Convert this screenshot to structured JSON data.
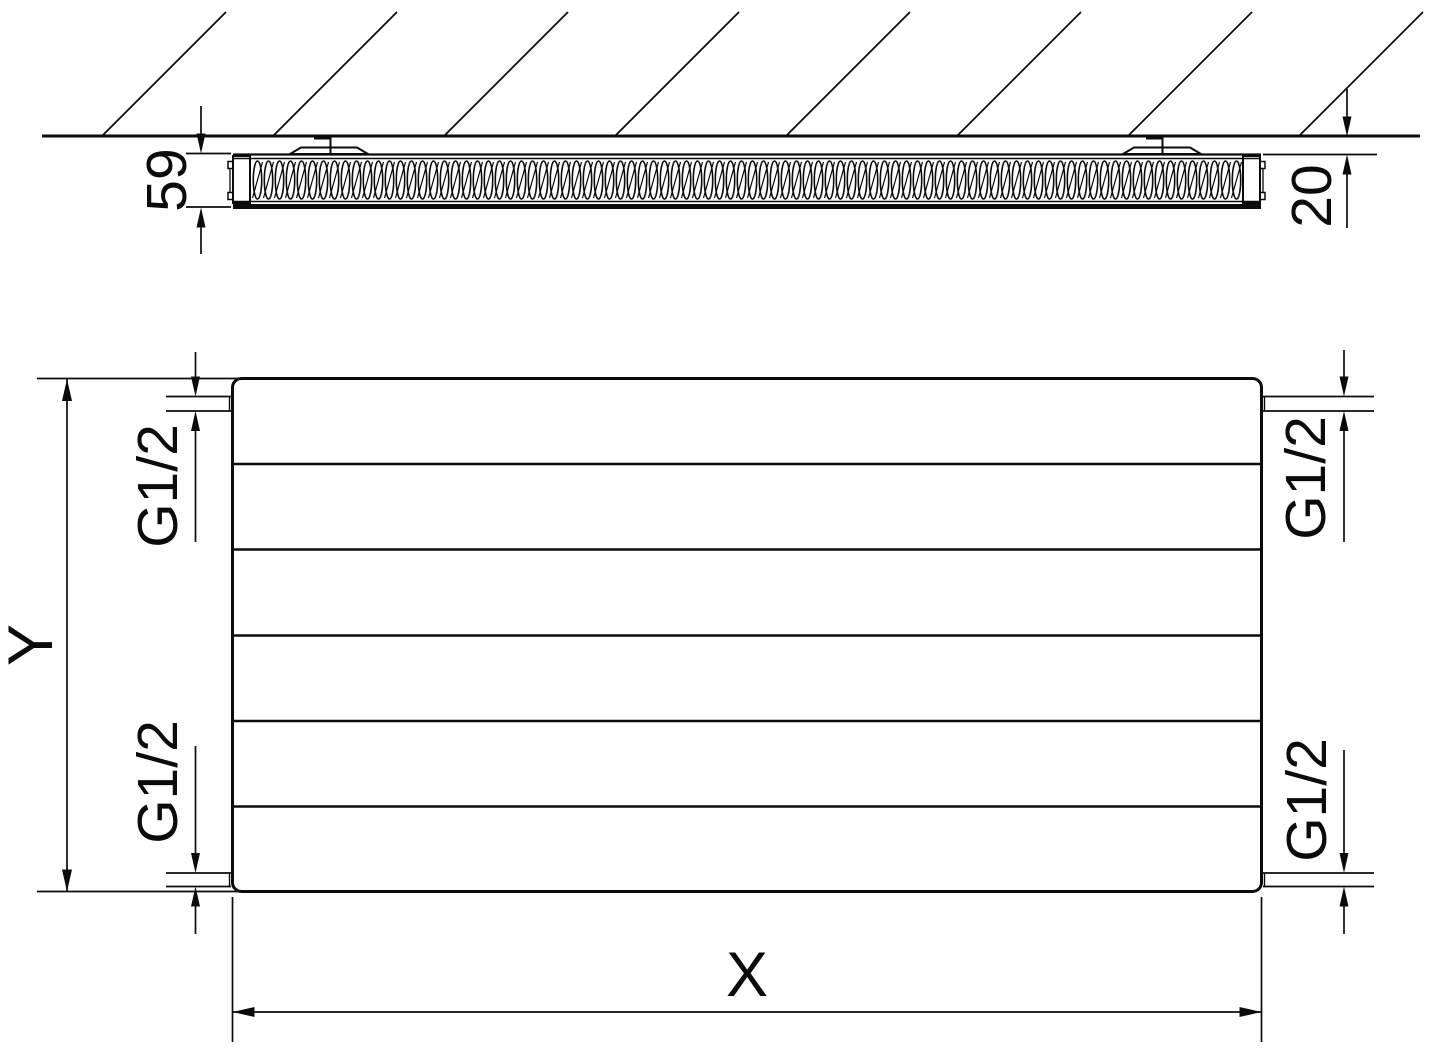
{
  "diagram": {
    "type": "radiator-technical-drawing",
    "colors": {
      "line": "#0b0b0b",
      "background": "#ffffff"
    },
    "top_section_view": {
      "depth_label": "59",
      "wall_gap_label": "20"
    },
    "front_view": {
      "width_label": "X",
      "height_label": "Y",
      "connections": {
        "top_left": "G1/2",
        "bottom_left": "G1/2",
        "top_right": "G1/2",
        "bottom_right": "G1/2"
      }
    }
  }
}
